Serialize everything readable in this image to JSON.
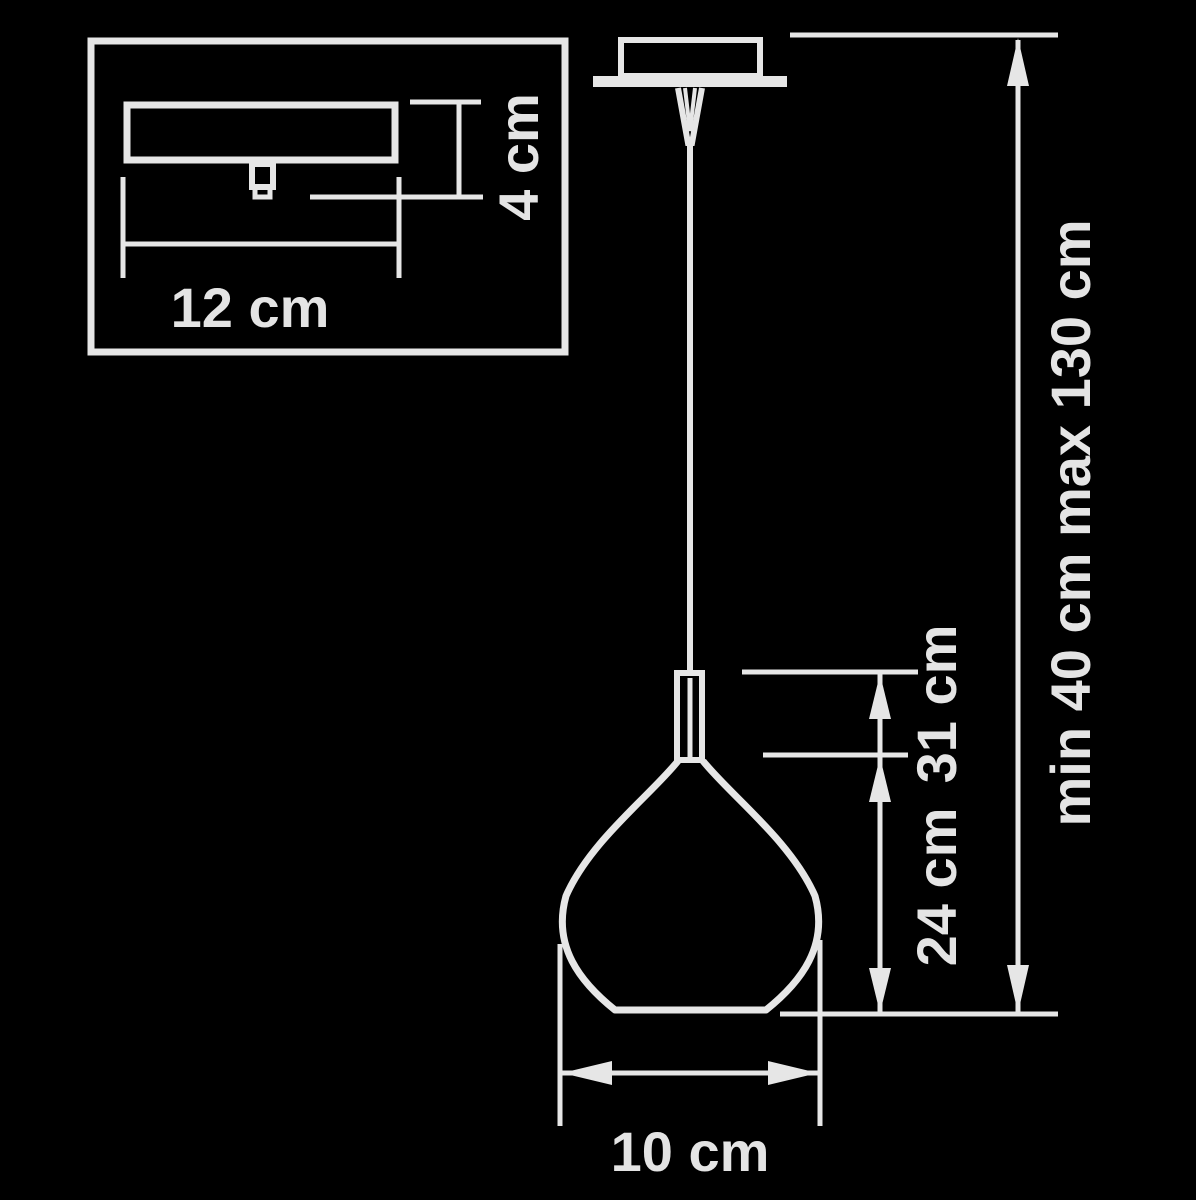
{
  "diagram": {
    "title": "pendant-lamp-dimension-drawing",
    "colors": {
      "background": "#000000",
      "line": "#e6e6e6",
      "text": "#e4e4e4"
    },
    "labels": {
      "canopy_width": "12 cm",
      "canopy_height": "4 cm",
      "fixture_height": "31 cm",
      "shade_height": "24 cm",
      "shade_diameter": "10 cm",
      "suspension_range": "min 40 cm max 130 cm"
    }
  }
}
